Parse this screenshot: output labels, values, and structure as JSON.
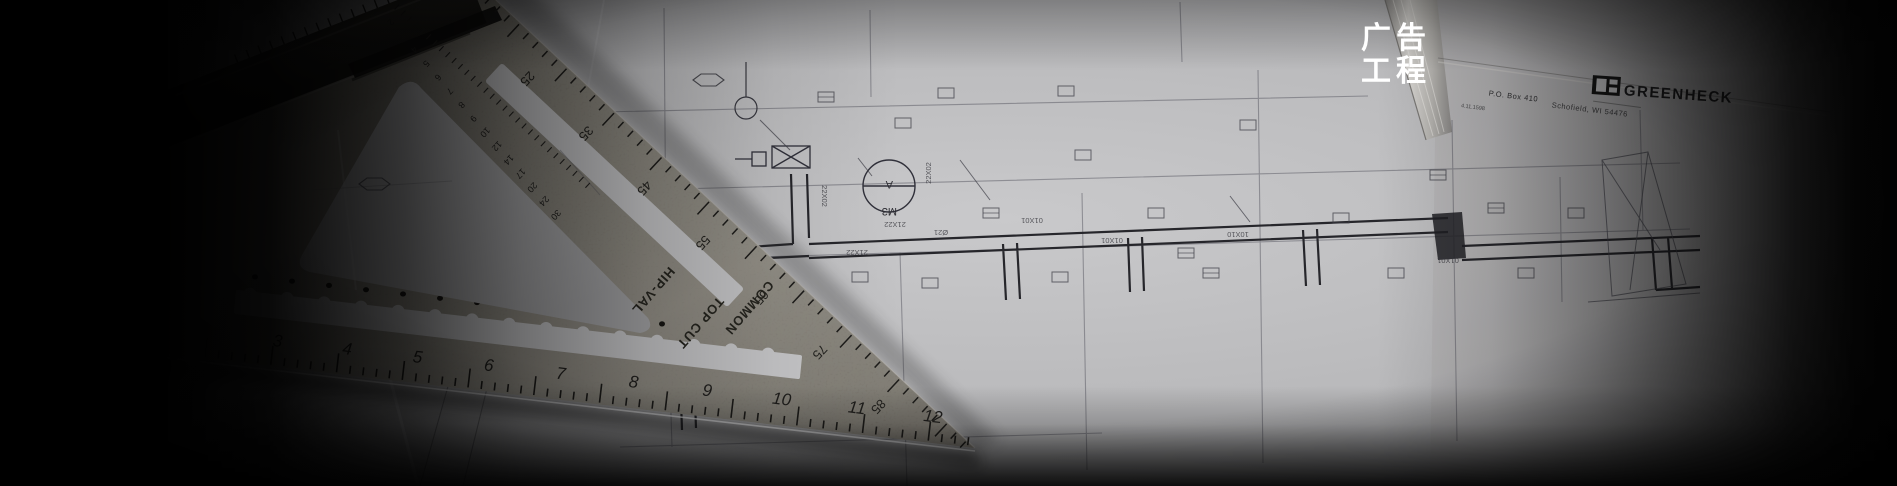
{
  "banner": {
    "slogan_line1": "广告",
    "slogan_line2": "工程",
    "slogan_color": "#ffffff"
  },
  "blueprint": {
    "title_block": {
      "po_box": "P.O. Box 410",
      "city": "Schofield, WI 54476",
      "date_code": "4.11.1598",
      "brand": "GREENHECK"
    },
    "fan_tag": {
      "top": "A",
      "bottom": "M3"
    },
    "duct_labels": [
      "21X22",
      "Ø21",
      "01X01",
      "21X22",
      "01X01",
      "22X02",
      "22X02",
      "10X10",
      "01X01"
    ]
  },
  "speed_square": {
    "edge_numbers": [
      "3",
      "4",
      "5",
      "6",
      "7",
      "8",
      "9",
      "10",
      "11",
      "12"
    ],
    "degree_numbers": [
      "25",
      "35",
      "45",
      "55",
      "65",
      "75",
      "85"
    ],
    "pitch_numbers": [
      "2",
      "3",
      "4",
      "5",
      "6",
      "7",
      "8",
      "9",
      "10",
      "12",
      "14",
      "17",
      "20",
      "24",
      "30"
    ],
    "markings": {
      "hip_val": "HIP-VAL",
      "top_cut": "TOP CUT",
      "common": "COMMON"
    }
  },
  "colors": {
    "paper": "#c6c6c8",
    "metal": "#76726a",
    "line": "#2e2e34",
    "slogan": "#ffffff"
  }
}
